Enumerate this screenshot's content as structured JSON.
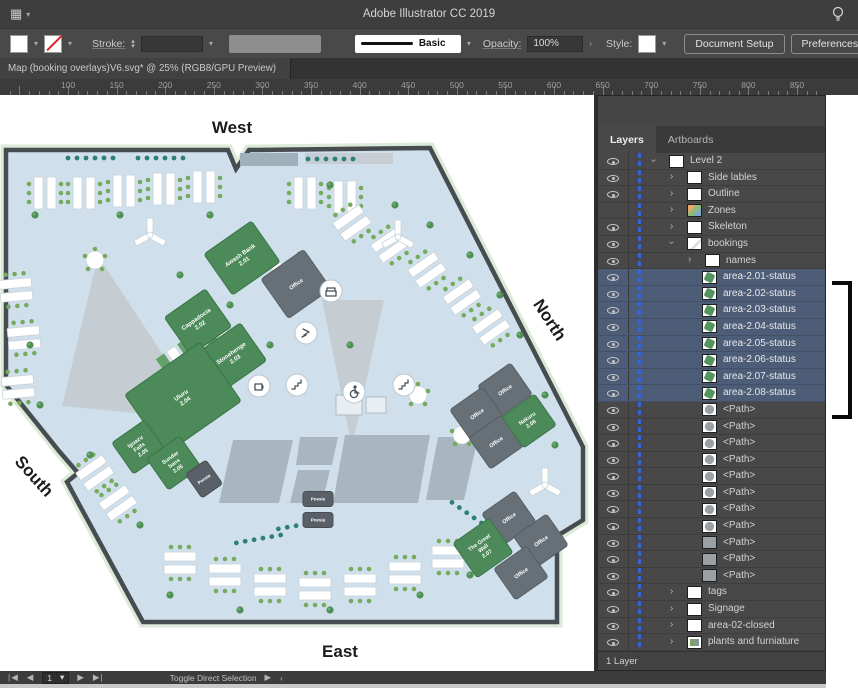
{
  "title_bar": {
    "title": "Adobe Illustrator CC 2019",
    "grid_menu_icon": "▦",
    "chevron_glyph": "▾",
    "lightbulb_icon": "lightbulb"
  },
  "control_bar": {
    "fill_swatch": "white",
    "stroke_swatch": "none",
    "stroke_label": "Stroke:",
    "brush_name": "Basic",
    "opacity_label": "Opacity:",
    "opacity_value": "100%",
    "style_label": "Style:",
    "document_setup_label": "Document Setup",
    "preferences_label": "Preferences"
  },
  "document_tab": {
    "label": "Map (booking overlays)V6.svg* @ 25% (RGB8/GPU Preview)"
  },
  "ruler": {
    "labels": [
      100,
      150,
      200,
      250,
      300,
      350,
      400,
      450,
      500,
      550,
      600,
      650,
      700,
      750,
      800,
      850
    ],
    "origin_x": 68,
    "px_per_unit": 0.972
  },
  "map": {
    "compass": {
      "west": "West",
      "north": "North",
      "south": "South",
      "east": "East"
    },
    "rooms": [
      {
        "lines": [
          "Awash Bank",
          "2.01"
        ],
        "x": 242,
        "y": 163,
        "w": 58,
        "h": 50,
        "rot": -35,
        "type": "green",
        "fs": 6
      },
      {
        "lines": [
          "Office"
        ],
        "x": 296,
        "y": 189,
        "w": 52,
        "h": 48,
        "rot": -35,
        "type": "gray",
        "fs": 5.5
      },
      {
        "lines": [
          "Cappadocia",
          "2.02"
        ],
        "x": 198,
        "y": 227,
        "w": 50,
        "h": 46,
        "rot": -35,
        "type": "green",
        "fs": 6
      },
      {
        "lines": [
          "Stonehenge",
          "2.03"
        ],
        "x": 233,
        "y": 261,
        "w": 50,
        "h": 46,
        "rot": -35,
        "type": "green",
        "fs": 6
      },
      {
        "lines": [
          "Uluru",
          "2.04"
        ],
        "x": 183,
        "y": 303,
        "w": 92,
        "h": 72,
        "rot": -35,
        "type": "green",
        "fs": 6
      },
      {
        "lines": [
          "Iguazu",
          "Falls",
          "2.05"
        ],
        "x": 139,
        "y": 352,
        "w": 40,
        "h": 38,
        "rot": -35,
        "type": "green",
        "fs": 5.5
      },
      {
        "lines": [
          "Sundar",
          "bans",
          "2.06"
        ],
        "x": 174,
        "y": 368,
        "w": 40,
        "h": 38,
        "rot": -35,
        "type": "green",
        "fs": 5.5
      },
      {
        "lines": [
          "Poesia"
        ],
        "x": 204,
        "y": 384,
        "w": 25,
        "h": 29,
        "rot": -35,
        "type": "dark",
        "fs": 4.5
      },
      {
        "lines": [
          "Office"
        ],
        "x": 505,
        "y": 295,
        "w": 40,
        "h": 38,
        "rot": -35,
        "type": "gray",
        "fs": 5.5
      },
      {
        "lines": [
          "Office"
        ],
        "x": 477,
        "y": 319,
        "w": 40,
        "h": 38,
        "rot": -35,
        "type": "gray",
        "fs": 5.5
      },
      {
        "lines": [
          "Office"
        ],
        "x": 496,
        "y": 347,
        "w": 40,
        "h": 38,
        "rot": -35,
        "type": "gray",
        "fs": 5.5
      },
      {
        "lines": [
          "Nakuru",
          "2.08"
        ],
        "x": 529,
        "y": 326,
        "w": 40,
        "h": 38,
        "rot": -35,
        "type": "green",
        "fs": 5.5
      },
      {
        "lines": [
          "Office"
        ],
        "x": 509,
        "y": 423,
        "w": 40,
        "h": 38,
        "rot": -35,
        "type": "gray",
        "fs": 5.5
      },
      {
        "lines": [
          "Office"
        ],
        "x": 541,
        "y": 446,
        "w": 40,
        "h": 38,
        "rot": -35,
        "type": "gray",
        "fs": 5.5
      },
      {
        "lines": [
          "Office"
        ],
        "x": 521,
        "y": 478,
        "w": 40,
        "h": 38,
        "rot": -35,
        "type": "gray",
        "fs": 5.5
      },
      {
        "lines": [
          "The Great",
          "Wall",
          "2.07"
        ],
        "x": 483,
        "y": 453,
        "w": 44,
        "h": 42,
        "rot": -35,
        "type": "green",
        "fs": 5.5
      },
      {
        "lines": [
          "Poesis"
        ],
        "x": 318,
        "y": 404,
        "w": 30,
        "h": 15,
        "rot": 0,
        "type": "dark",
        "fs": 4.5
      },
      {
        "lines": [
          "Poesia"
        ],
        "x": 318,
        "y": 425,
        "w": 30,
        "h": 15,
        "rot": 0,
        "type": "dark",
        "fs": 4.5
      }
    ],
    "amenity_icons": [
      "printer",
      "phone-booth",
      "coffee",
      "stairs",
      "accessible-toilet",
      "stairs"
    ]
  },
  "layers_panel": {
    "tabs": [
      "Layers",
      "Artboards"
    ],
    "rows": [
      {
        "label": "Level 2",
        "eye": true,
        "chev": "open",
        "thumb": "white",
        "indent": 0
      },
      {
        "label": "Side lables",
        "eye": true,
        "chev": "closed",
        "thumb": "white",
        "indent": 1
      },
      {
        "label": "Outline",
        "eye": true,
        "chev": "closed",
        "thumb": "white",
        "indent": 1
      },
      {
        "label": "Zones",
        "eye": false,
        "chev": "closed",
        "thumb": "zones",
        "indent": 1
      },
      {
        "label": "Skeleton",
        "eye": true,
        "chev": "closed",
        "thumb": "white",
        "indent": 1
      },
      {
        "label": "bookings",
        "eye": true,
        "chev": "open",
        "thumb": "sketch",
        "indent": 1
      },
      {
        "label": "names",
        "eye": true,
        "chev": "closed",
        "thumb": "white",
        "indent": 2
      },
      {
        "label": "area-2.01-status",
        "eye": true,
        "chev": null,
        "thumb": "green",
        "indent": 3,
        "selected": true
      },
      {
        "label": "area-2.02-status",
        "eye": true,
        "chev": null,
        "thumb": "green",
        "indent": 3,
        "selected": true
      },
      {
        "label": "area-2.03-status",
        "eye": true,
        "chev": null,
        "thumb": "green",
        "indent": 3,
        "selected": true
      },
      {
        "label": "area-2.04-status",
        "eye": true,
        "chev": null,
        "thumb": "green",
        "indent": 3,
        "selected": true
      },
      {
        "label": "area-2.05-status",
        "eye": true,
        "chev": null,
        "thumb": "green",
        "indent": 3,
        "selected": true
      },
      {
        "label": "area-2.06-status",
        "eye": true,
        "chev": null,
        "thumb": "green",
        "indent": 3,
        "selected": true
      },
      {
        "label": "area-2.07-status",
        "eye": true,
        "chev": null,
        "thumb": "green",
        "indent": 3,
        "selected": true
      },
      {
        "label": "area-2.08-status",
        "eye": true,
        "chev": null,
        "thumb": "green",
        "indent": 3,
        "selected": true
      },
      {
        "label": "<Path>",
        "eye": true,
        "chev": null,
        "thumb": "swirl",
        "indent": 3
      },
      {
        "label": "<Path>",
        "eye": true,
        "chev": null,
        "thumb": "swirl",
        "indent": 3
      },
      {
        "label": "<Path>",
        "eye": true,
        "chev": null,
        "thumb": "swirl",
        "indent": 3
      },
      {
        "label": "<Path>",
        "eye": true,
        "chev": null,
        "thumb": "swirl",
        "indent": 3
      },
      {
        "label": "<Path>",
        "eye": true,
        "chev": null,
        "thumb": "swirl",
        "indent": 3
      },
      {
        "label": "<Path>",
        "eye": true,
        "chev": null,
        "thumb": "swirl",
        "indent": 3
      },
      {
        "label": "<Path>",
        "eye": true,
        "chev": null,
        "thumb": "swirl",
        "indent": 3
      },
      {
        "label": "<Path>",
        "eye": true,
        "chev": null,
        "thumb": "swirl",
        "indent": 3
      },
      {
        "label": "<Path>",
        "eye": true,
        "chev": null,
        "thumb": "gray",
        "indent": 3
      },
      {
        "label": "<Path>",
        "eye": true,
        "chev": null,
        "thumb": "gray",
        "indent": 3
      },
      {
        "label": "<Path>",
        "eye": true,
        "chev": null,
        "thumb": "gray",
        "indent": 3
      },
      {
        "label": "tags",
        "eye": true,
        "chev": "closed",
        "thumb": "white",
        "indent": 1
      },
      {
        "label": "Signage",
        "eye": true,
        "chev": "closed",
        "thumb": "white",
        "indent": 1
      },
      {
        "label": "area-02-closed",
        "eye": true,
        "chev": "closed",
        "thumb": "white",
        "indent": 1
      },
      {
        "label": "plants and furniature",
        "eye": true,
        "chev": "closed",
        "thumb": "picture",
        "indent": 1
      }
    ],
    "status_text": "1 Layer"
  },
  "status_bar": {
    "first_glyph": "|◀",
    "prev_glyph": "◀",
    "artboard_value": "1",
    "chevron_glyph": "▾",
    "next_glyph": "▶",
    "last_glyph": "▶|",
    "hint": "Toggle Direct Selection",
    "play_glyph": "▶",
    "back_glyph": "‹"
  },
  "colors": {
    "selection_blue": "#3565d8",
    "room_green": "#4c8a59",
    "room_gray": "#677077",
    "floor_blue": "#cfe0ec",
    "selected_row": "#4d5d78"
  }
}
